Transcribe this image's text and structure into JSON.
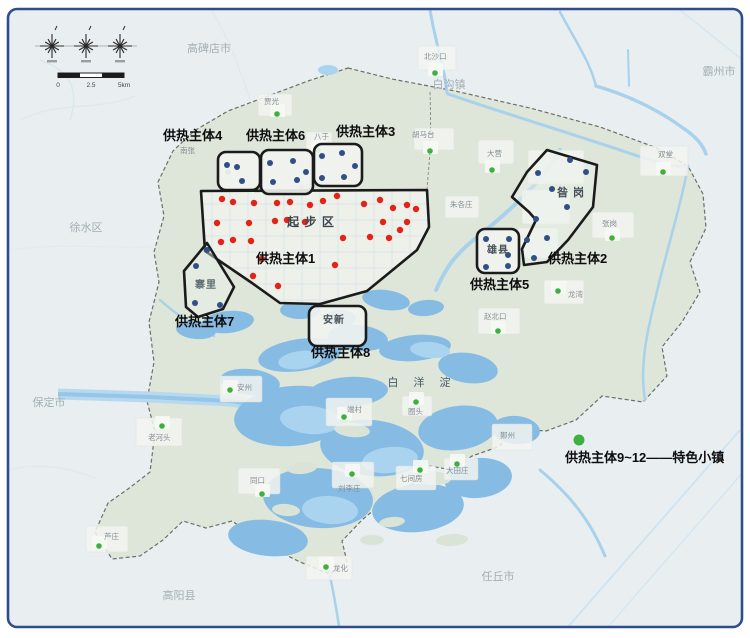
{
  "map_title": "雄安新区供热主体规划图",
  "colors": {
    "frame_border": "#2e4d8c",
    "outside_bg": "#e9eff1",
    "area_fill": "#dde6d8",
    "water": "#86bce4",
    "water_light": "#a9d3ee",
    "river": "#a8d1ec",
    "urban": "#f3f5f1",
    "zone_border": "#1b1b1b",
    "red_dot": "#e42318",
    "blue_dot": "#2f4f86",
    "green_dot": "#3db03f",
    "label_dark": "#0d0d0d",
    "city_gray": "#a3aeb4",
    "town_gray": "#848f95"
  },
  "compass": {
    "scale_ticks": [
      "0",
      "2.5",
      "5km"
    ]
  },
  "legend": {
    "text": "供热主体9~12——特色小镇",
    "dot_x": 579,
    "dot_y": 440,
    "text_x": 565,
    "text_y": 462
  },
  "lake_label": {
    "text": "白 洋 淀",
    "x": 422,
    "y": 386
  },
  "inner_labels": [
    {
      "text": "起 步 区",
      "x": 311,
      "y": 226,
      "size": 12,
      "color": "#3d464d"
    },
    {
      "text": "昝 岗",
      "x": 571,
      "y": 196,
      "size": 11,
      "color": "#49525a"
    },
    {
      "text": "雄县",
      "x": 498,
      "y": 253,
      "size": 10,
      "color": "#49525a"
    },
    {
      "text": "安新",
      "x": 334,
      "y": 323,
      "size": 10,
      "color": "#49525a"
    },
    {
      "text": "寨里",
      "x": 206,
      "y": 288,
      "size": 10,
      "color": "#5d6a72"
    }
  ],
  "cities": [
    {
      "name": "高碑店市",
      "x": 209,
      "y": 52
    },
    {
      "name": "白沟镇",
      "x": 449,
      "y": 88
    },
    {
      "name": "霸州市",
      "x": 719,
      "y": 75
    },
    {
      "name": "徐水区",
      "x": 86,
      "y": 231
    },
    {
      "name": "保定市",
      "x": 49,
      "y": 406
    },
    {
      "name": "高阳县",
      "x": 179,
      "y": 599
    },
    {
      "name": "任丘市",
      "x": 498,
      "y": 580
    }
  ],
  "towns": [
    {
      "name": "北沙口",
      "tx": 424,
      "ty": 59,
      "dx": 435,
      "dy": 73
    },
    {
      "name": "贾光",
      "tx": 264,
      "ty": 104,
      "dx": 277,
      "dy": 114
    },
    {
      "name": "南张",
      "tx": 180,
      "ty": 153,
      "dx": 228,
      "dy": 172
    },
    {
      "name": "八于",
      "tx": 314,
      "ty": 139,
      "dx": 318,
      "dy": 150
    },
    {
      "name": "胡马台",
      "tx": 412,
      "ty": 137,
      "dx": 430,
      "dy": 151
    },
    {
      "name": "三台",
      "tx": 246,
      "ty": 190
    },
    {
      "name": "大王",
      "tx": 298,
      "ty": 190
    },
    {
      "name": "大营",
      "tx": 487,
      "ty": 156,
      "dx": 492,
      "dy": 170
    },
    {
      "name": "双堂",
      "tx": 658,
      "ty": 157,
      "dx": 663,
      "dy": 172
    },
    {
      "name": "朱各庄",
      "tx": 450,
      "ty": 207
    },
    {
      "name": "张岗",
      "tx": 602,
      "ty": 226,
      "dx": 612,
      "dy": 238
    },
    {
      "name": "龙湾",
      "tx": 568,
      "ty": 297,
      "dx": 558,
      "dy": 291
    },
    {
      "name": "赵北口",
      "tx": 484,
      "ty": 319,
      "dx": 498,
      "dy": 331
    },
    {
      "name": "圈头",
      "tx": 408,
      "ty": 414,
      "dx": 416,
      "dy": 402
    },
    {
      "name": "鄚州",
      "tx": 500,
      "ty": 438
    },
    {
      "name": "大田庄",
      "tx": 446,
      "ty": 473,
      "dx": 457,
      "dy": 464
    },
    {
      "name": "七间房",
      "tx": 400,
      "ty": 481,
      "dx": 420,
      "dy": 470
    },
    {
      "name": "刘李庄",
      "tx": 338,
      "ty": 491,
      "dx": 352,
      "dy": 474
    },
    {
      "name": "同口",
      "tx": 250,
      "ty": 483,
      "dx": 262,
      "dy": 494
    },
    {
      "name": "端村",
      "tx": 347,
      "ty": 412,
      "dx": 344,
      "dy": 417
    },
    {
      "name": "安州",
      "tx": 237,
      "ty": 390,
      "dx": 230,
      "dy": 390
    },
    {
      "name": "老河头",
      "tx": 148,
      "ty": 440,
      "dx": 162,
      "dy": 426
    },
    {
      "name": "芦庄",
      "tx": 104,
      "ty": 539,
      "dx": 99,
      "dy": 546
    },
    {
      "name": "龙化",
      "tx": 333,
      "ty": 571,
      "dx": 326,
      "dy": 567
    }
  ],
  "zones": [
    {
      "id": "1",
      "label": "供热主体1",
      "lx": 256,
      "ly": 263,
      "type": "polygon",
      "points": "201,191 427,190 429,227 417,250 367,291 320,304 280,303 252,283 205,251",
      "dot_color": "#e42318",
      "dots": [
        [
          222,
          199
        ],
        [
          233,
          202
        ],
        [
          254,
          203
        ],
        [
          277,
          203
        ],
        [
          290,
          202
        ],
        [
          310,
          205
        ],
        [
          323,
          201
        ],
        [
          337,
          196
        ],
        [
          364,
          204
        ],
        [
          380,
          200
        ],
        [
          393,
          208
        ],
        [
          407,
          205
        ],
        [
          416,
          209
        ],
        [
          217,
          223
        ],
        [
          249,
          223
        ],
        [
          275,
          221
        ],
        [
          287,
          220
        ],
        [
          305,
          222
        ],
        [
          343,
          238
        ],
        [
          383,
          222
        ],
        [
          400,
          230
        ],
        [
          407,
          222
        ],
        [
          221,
          242
        ],
        [
          233,
          240
        ],
        [
          251,
          241
        ],
        [
          262,
          259
        ],
        [
          370,
          237
        ],
        [
          389,
          238
        ],
        [
          253,
          276
        ],
        [
          278,
          286
        ],
        [
          335,
          265
        ]
      ]
    },
    {
      "id": "2",
      "label": "供热主体2",
      "lx": 548,
      "ly": 263,
      "type": "polygon",
      "points": "547,150 597,165 593,207 568,240 547,262 524,265 522,249 536,220 529,212 512,197 527,172",
      "dot_color": "#2f4f86",
      "dots": [
        [
          570,
          160
        ],
        [
          538,
          173
        ],
        [
          586,
          172
        ],
        [
          552,
          189
        ],
        [
          567,
          207
        ],
        [
          536,
          219
        ],
        [
          527,
          240
        ],
        [
          547,
          238
        ],
        [
          534,
          258
        ]
      ]
    },
    {
      "id": "3",
      "label": "供热主体3",
      "lx": 336,
      "ly": 136,
      "type": "rect",
      "x": 314,
      "y": 144,
      "w": 48,
      "h": 42,
      "dot_color": "#2f4f86",
      "dots": [
        [
          322,
          156
        ],
        [
          342,
          153
        ],
        [
          355,
          166
        ],
        [
          322,
          178
        ],
        [
          344,
          177
        ]
      ]
    },
    {
      "id": "4",
      "label": "供热主体4",
      "lx": 163,
      "ly": 140,
      "type": "rect",
      "x": 218,
      "y": 152,
      "w": 42,
      "h": 38,
      "dot_color": "#2f4f86",
      "dots": [
        [
          227,
          165
        ],
        [
          237,
          167
        ],
        [
          242,
          181
        ]
      ]
    },
    {
      "id": "5",
      "label": "供热主体5",
      "lx": 470,
      "ly": 289,
      "type": "rect",
      "x": 477,
      "y": 229,
      "w": 42,
      "h": 44,
      "dot_color": "#2f4f86",
      "dots": [
        [
          486,
          239
        ],
        [
          509,
          239
        ],
        [
          508,
          255
        ],
        [
          486,
          267
        ],
        [
          508,
          266
        ]
      ]
    },
    {
      "id": "6",
      "label": "供热主体6",
      "lx": 246,
      "ly": 140,
      "type": "rect",
      "x": 261,
      "y": 150,
      "w": 52,
      "h": 44,
      "dot_color": "#2f4f86",
      "dots": [
        [
          270,
          163
        ],
        [
          293,
          161
        ],
        [
          306,
          172
        ],
        [
          273,
          182
        ],
        [
          297,
          180
        ]
      ]
    },
    {
      "id": "7",
      "label": "供热主体7",
      "lx": 175,
      "ly": 326,
      "type": "polygon",
      "points": "207,243 184,271 186,307 198,317 223,309 234,287",
      "dot_color": "#2f4f86",
      "dots": [
        [
          207,
          250
        ],
        [
          196,
          266
        ],
        [
          195,
          303
        ],
        [
          220,
          305
        ]
      ]
    },
    {
      "id": "8",
      "label": "供热主体8",
      "lx": 311,
      "ly": 357,
      "type": "rect",
      "x": 309,
      "y": 306,
      "w": 57,
      "h": 40,
      "dot_color": "#2f4f86",
      "dots": []
    }
  ]
}
